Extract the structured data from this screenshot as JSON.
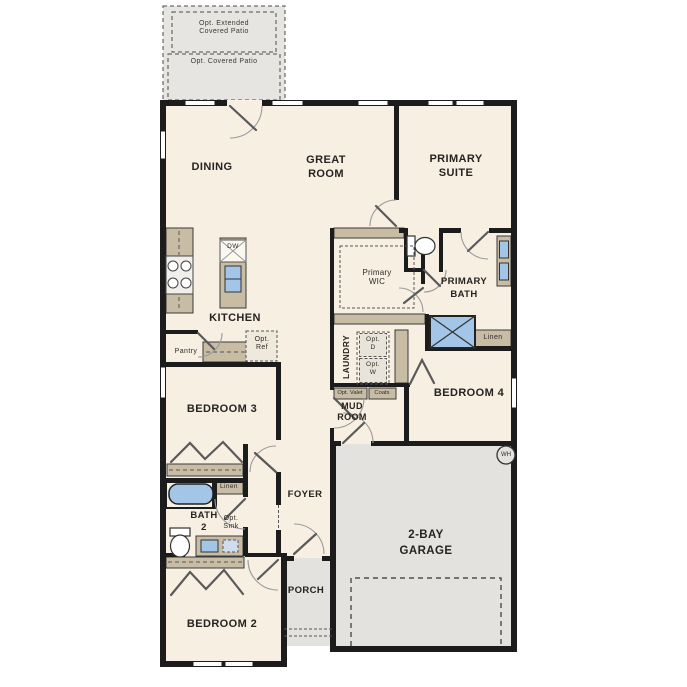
{
  "labels": {
    "opt_extended_patio": "Opt. Extended\nCovered Patio",
    "opt_covered_patio": "Opt. Covered Patio",
    "dining": "DINING",
    "great_room": "GREAT\nROOM",
    "primary_suite": "PRIMARY\nSUITE",
    "kitchen": "KITCHEN",
    "dw": "DW",
    "pantry": "Pantry",
    "opt_ref": "Opt.\nRef",
    "primary_wic": "Primary\nWIC",
    "primary_bath": "PRIMARY\nBATH",
    "linen_primary": "Linen",
    "laundry": "LAUNDRY",
    "opt_dryer": "Opt.\nD",
    "opt_washer": "Opt.\nW",
    "opt_valet": "Opt. Valet",
    "coats": "Coats",
    "mud_room": "MUD\nROOM",
    "bedroom4": "BEDROOM 4",
    "bedroom3": "BEDROOM 3",
    "linen_bath2": "Linen",
    "bath2": "BATH\n2",
    "opt_sink": "Opt.\nSink",
    "bedroom2": "BEDROOM 2",
    "foyer": "FOYER",
    "porch": "PORCH",
    "garage": "2-BAY\nGARAGE",
    "water_heater": "WH"
  },
  "colors": {
    "floor": "#f6efe2",
    "hard_surface": "#e3e2de",
    "cabinet": "#c9bca4",
    "fixture_blue": "#a3c6e8",
    "wall": "#1c1c1c",
    "label_text": "#2e2b27"
  }
}
